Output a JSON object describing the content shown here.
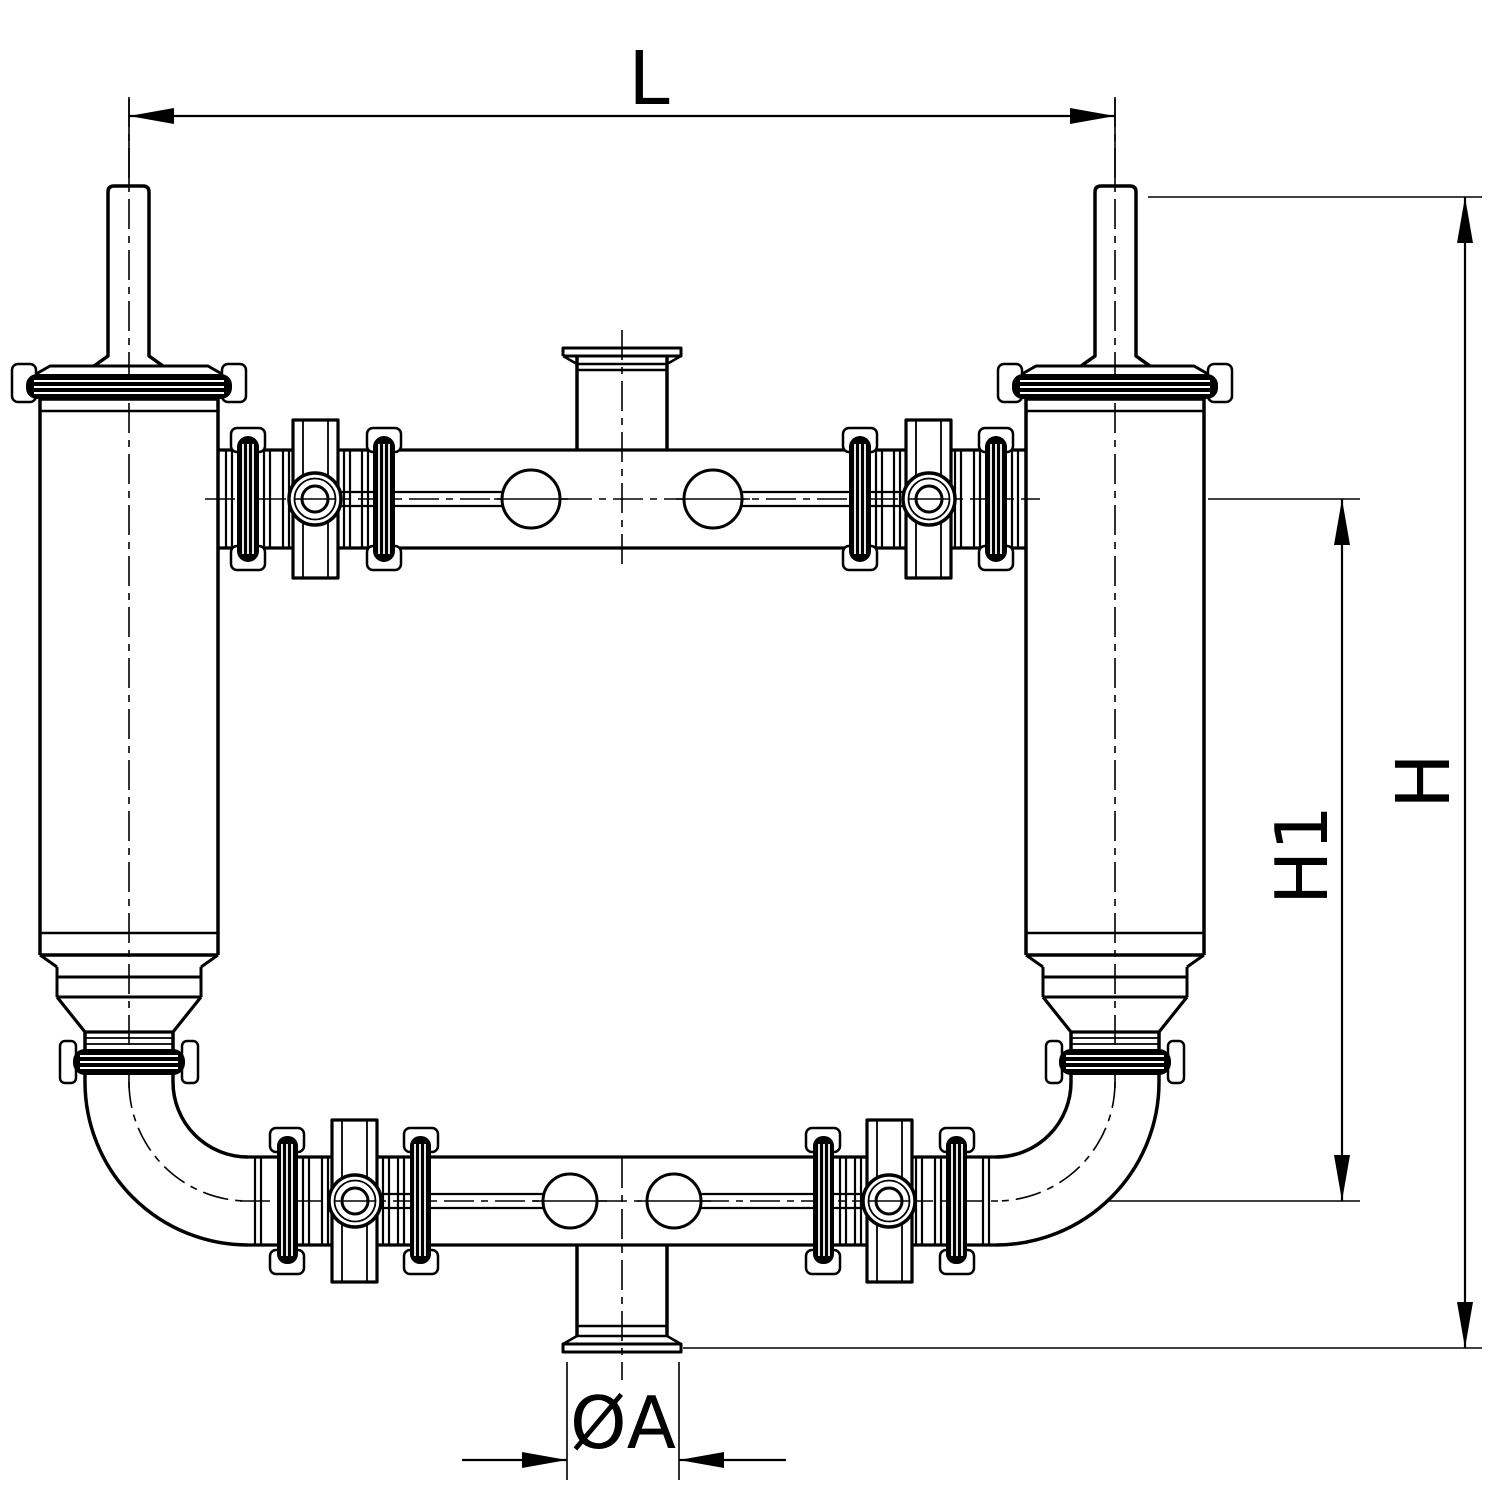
{
  "drawing": {
    "dimension_labels": {
      "length": "L",
      "overall_height": "H",
      "manifold_height": "H1",
      "port_diameter": "ØA"
    },
    "palette": {
      "line": "#000000",
      "background": "#ffffff"
    }
  }
}
